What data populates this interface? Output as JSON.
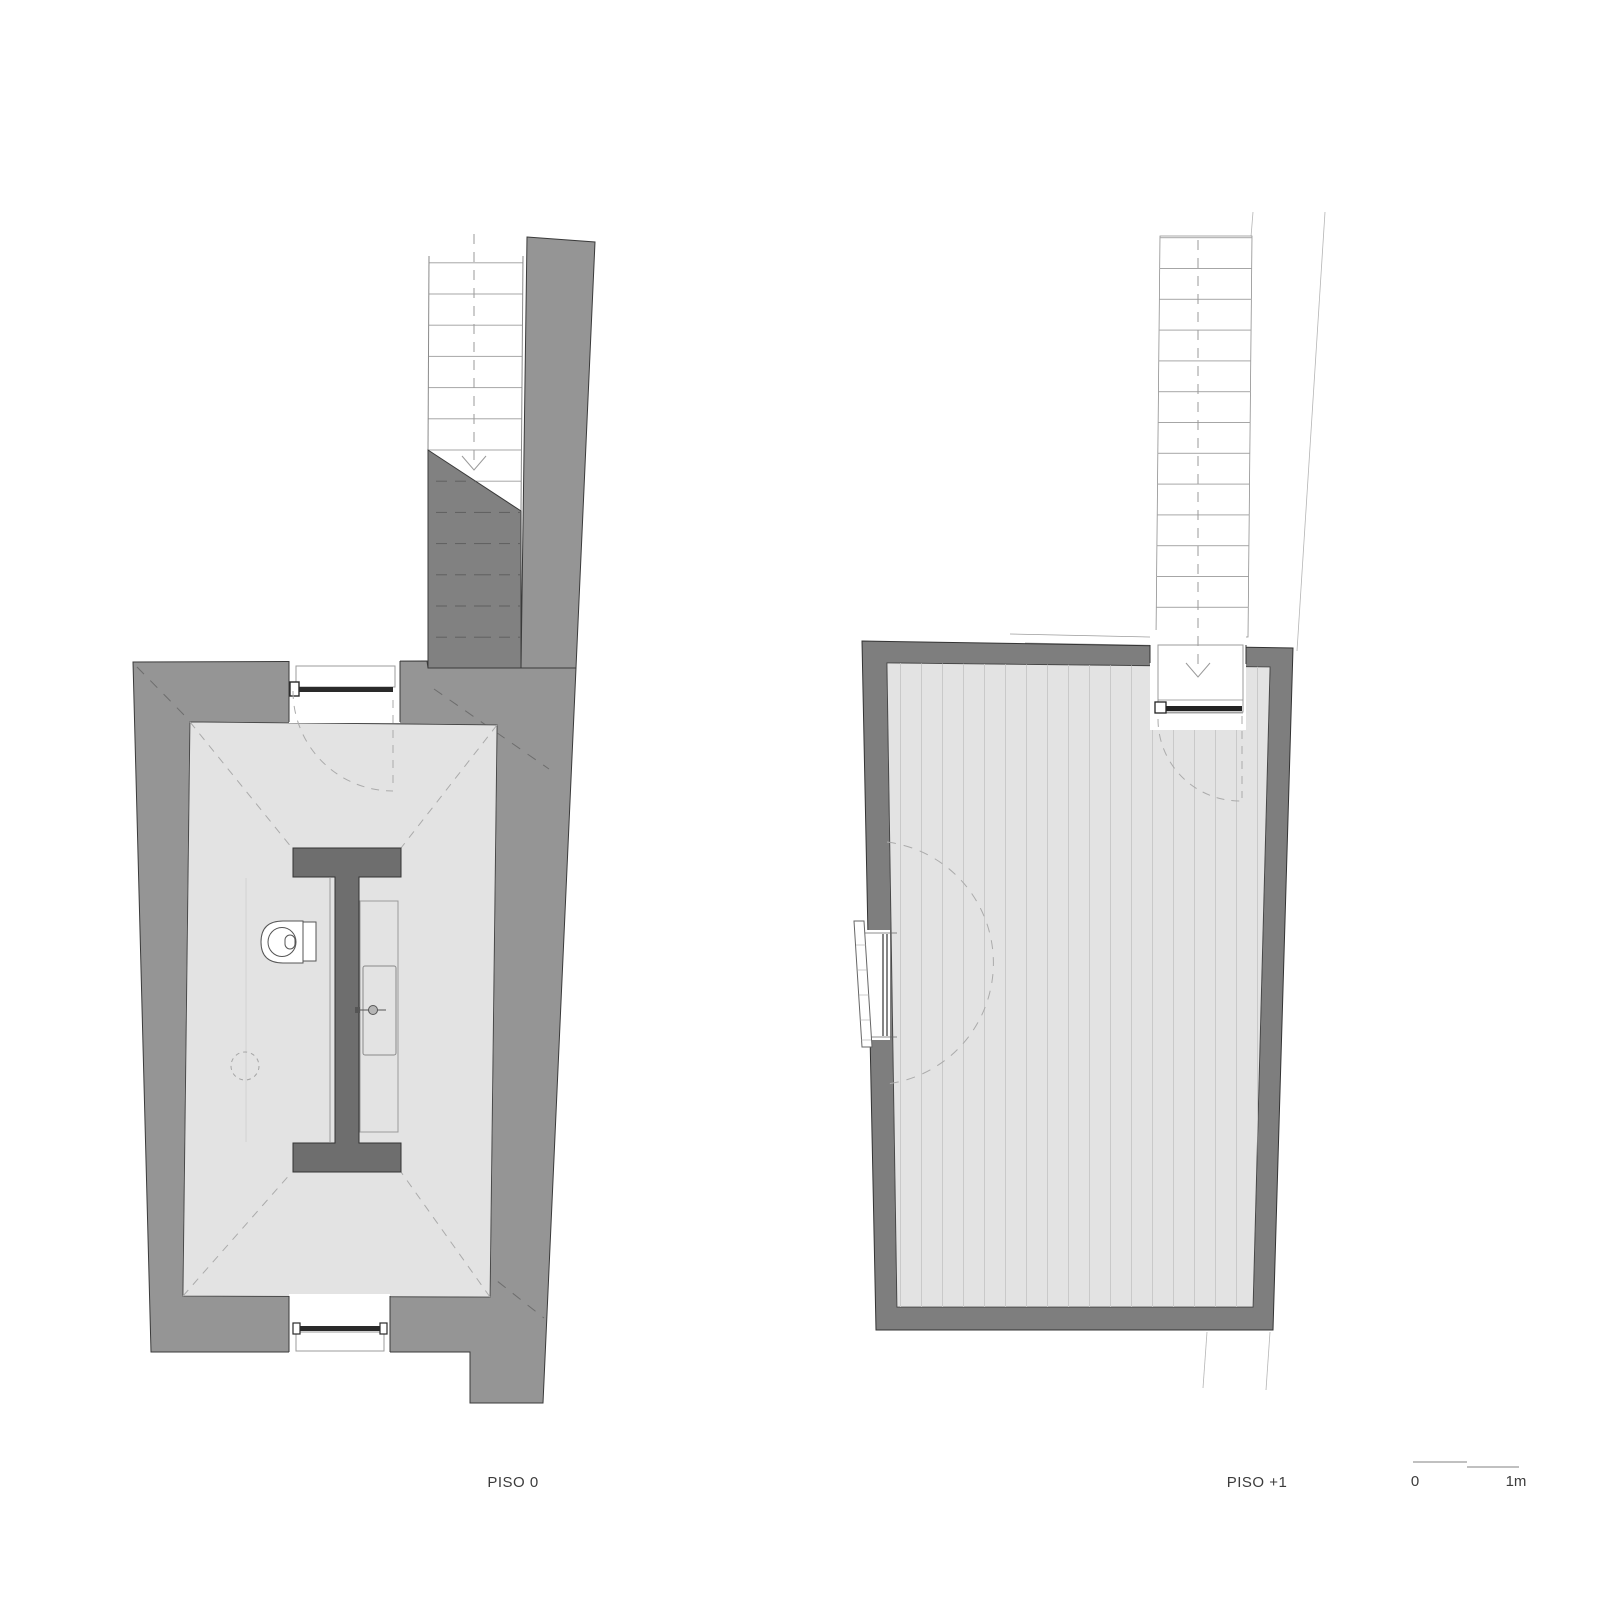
{
  "document": {
    "type": "architectural-floor-plan-drawing",
    "background": "#ffffff"
  },
  "plans": [
    {
      "id": "piso-0",
      "label": "PISO 0",
      "features": [
        "staircase-down",
        "bathroom",
        "toilet",
        "washbasin-vanity",
        "i-beam-partition",
        "sliding-doors",
        "floor-drain"
      ]
    },
    {
      "id": "piso-plus-1",
      "label": "PISO +1",
      "features": [
        "staircase-down",
        "stair-landing",
        "wood-plank-floor",
        "entry-door",
        "door-swing"
      ]
    }
  ],
  "scale_bar": {
    "zero_label": "0",
    "one_meter_label": "1m"
  },
  "palette": {
    "wall_gray": "#959595",
    "under_stair_gray": "#818181",
    "upper_wall_gray": "#7e7e7e",
    "floor_gray": "#e3e3e3",
    "plank_line_gray": "#c9c9c9",
    "ibeam_gray": "#6e6e6e",
    "outline_dark": "#3a3a3a",
    "dashed_light": "#ababab",
    "text_gray": "#3c3c3c"
  }
}
